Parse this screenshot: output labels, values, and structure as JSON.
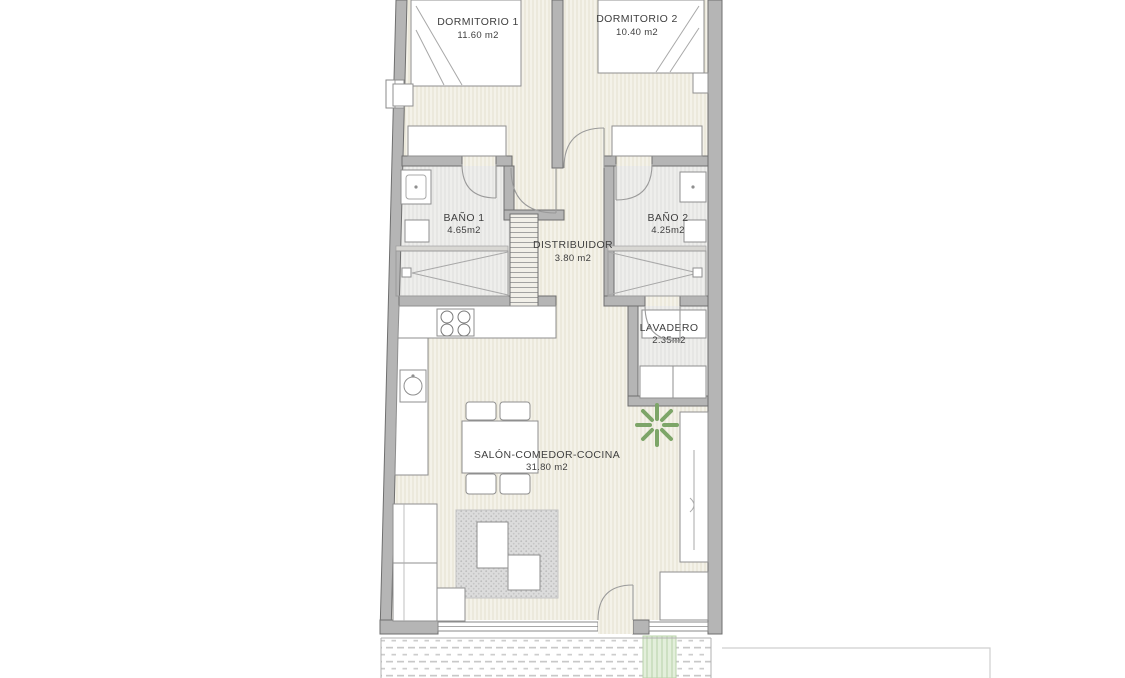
{
  "meta": {
    "type": "floor-plan",
    "language": "es"
  },
  "rooms": [
    {
      "name": "DORMITORIO 1",
      "area": "11.60 m2"
    },
    {
      "name": "DORMITORIO 2",
      "area": "10.40 m2"
    },
    {
      "name": "BAÑO 1",
      "area": "4.65m2"
    },
    {
      "name": "BAÑO 2",
      "area": "4.25m2"
    },
    {
      "name": "DISTRIBUIDOR",
      "area": "3.80 m2"
    },
    {
      "name": "LAVADERO",
      "area": "2.35m2"
    },
    {
      "name": "SALÓN-COMEDOR-COCINA",
      "area": "31.80 m2"
    }
  ],
  "colors": {
    "wall": "#b5b5b5",
    "wall_outline": "#6f6f6f",
    "floor": "#f4f2e9",
    "wet_floor": "#eeeeec",
    "plant_green": "#7da568",
    "lawn_green": "#e3efdb",
    "text": "#3f3f3f"
  }
}
